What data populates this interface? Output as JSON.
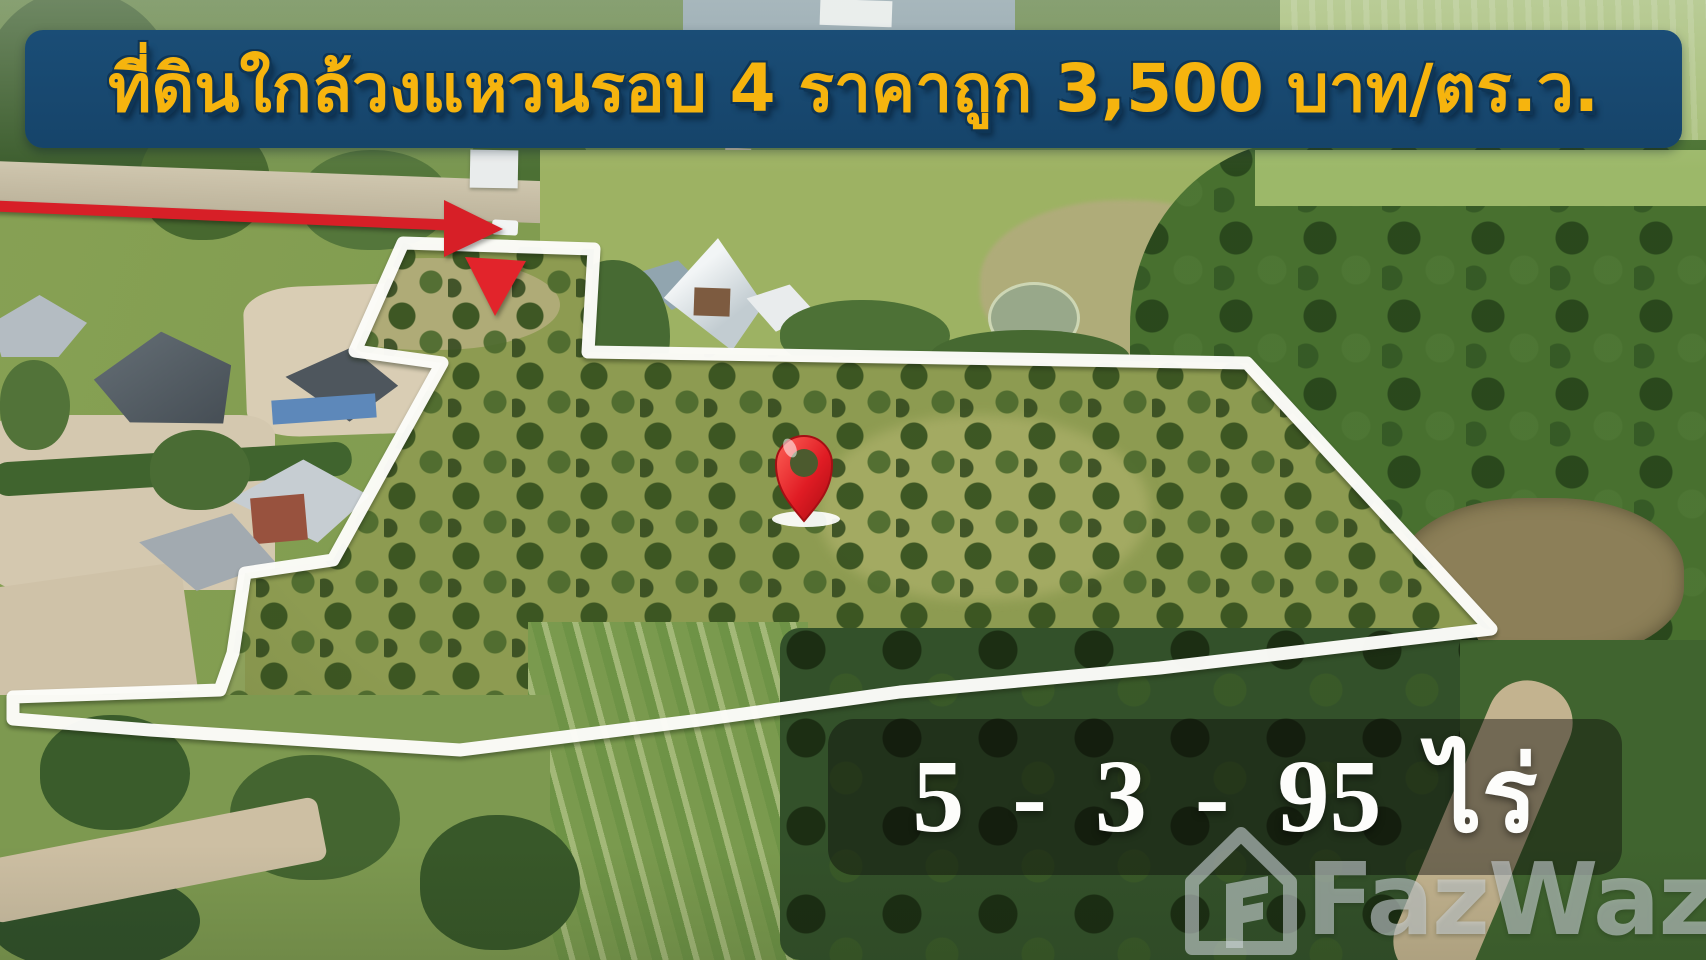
{
  "banner": {
    "text": "ที่ดินใกล้วงแหวนรอบ 4 ราคาถูก 3,500 บาท/ตร.ว.",
    "background_color": "#16446a",
    "text_color": "#f6b40e"
  },
  "land": {
    "size_label": "5 - 3 - 95 ไร่",
    "boundary_color": "#ffffff",
    "marker_color": "#d91f27",
    "pin_color": "#e01c24"
  },
  "watermark": {
    "brand": "FazWaz"
  }
}
